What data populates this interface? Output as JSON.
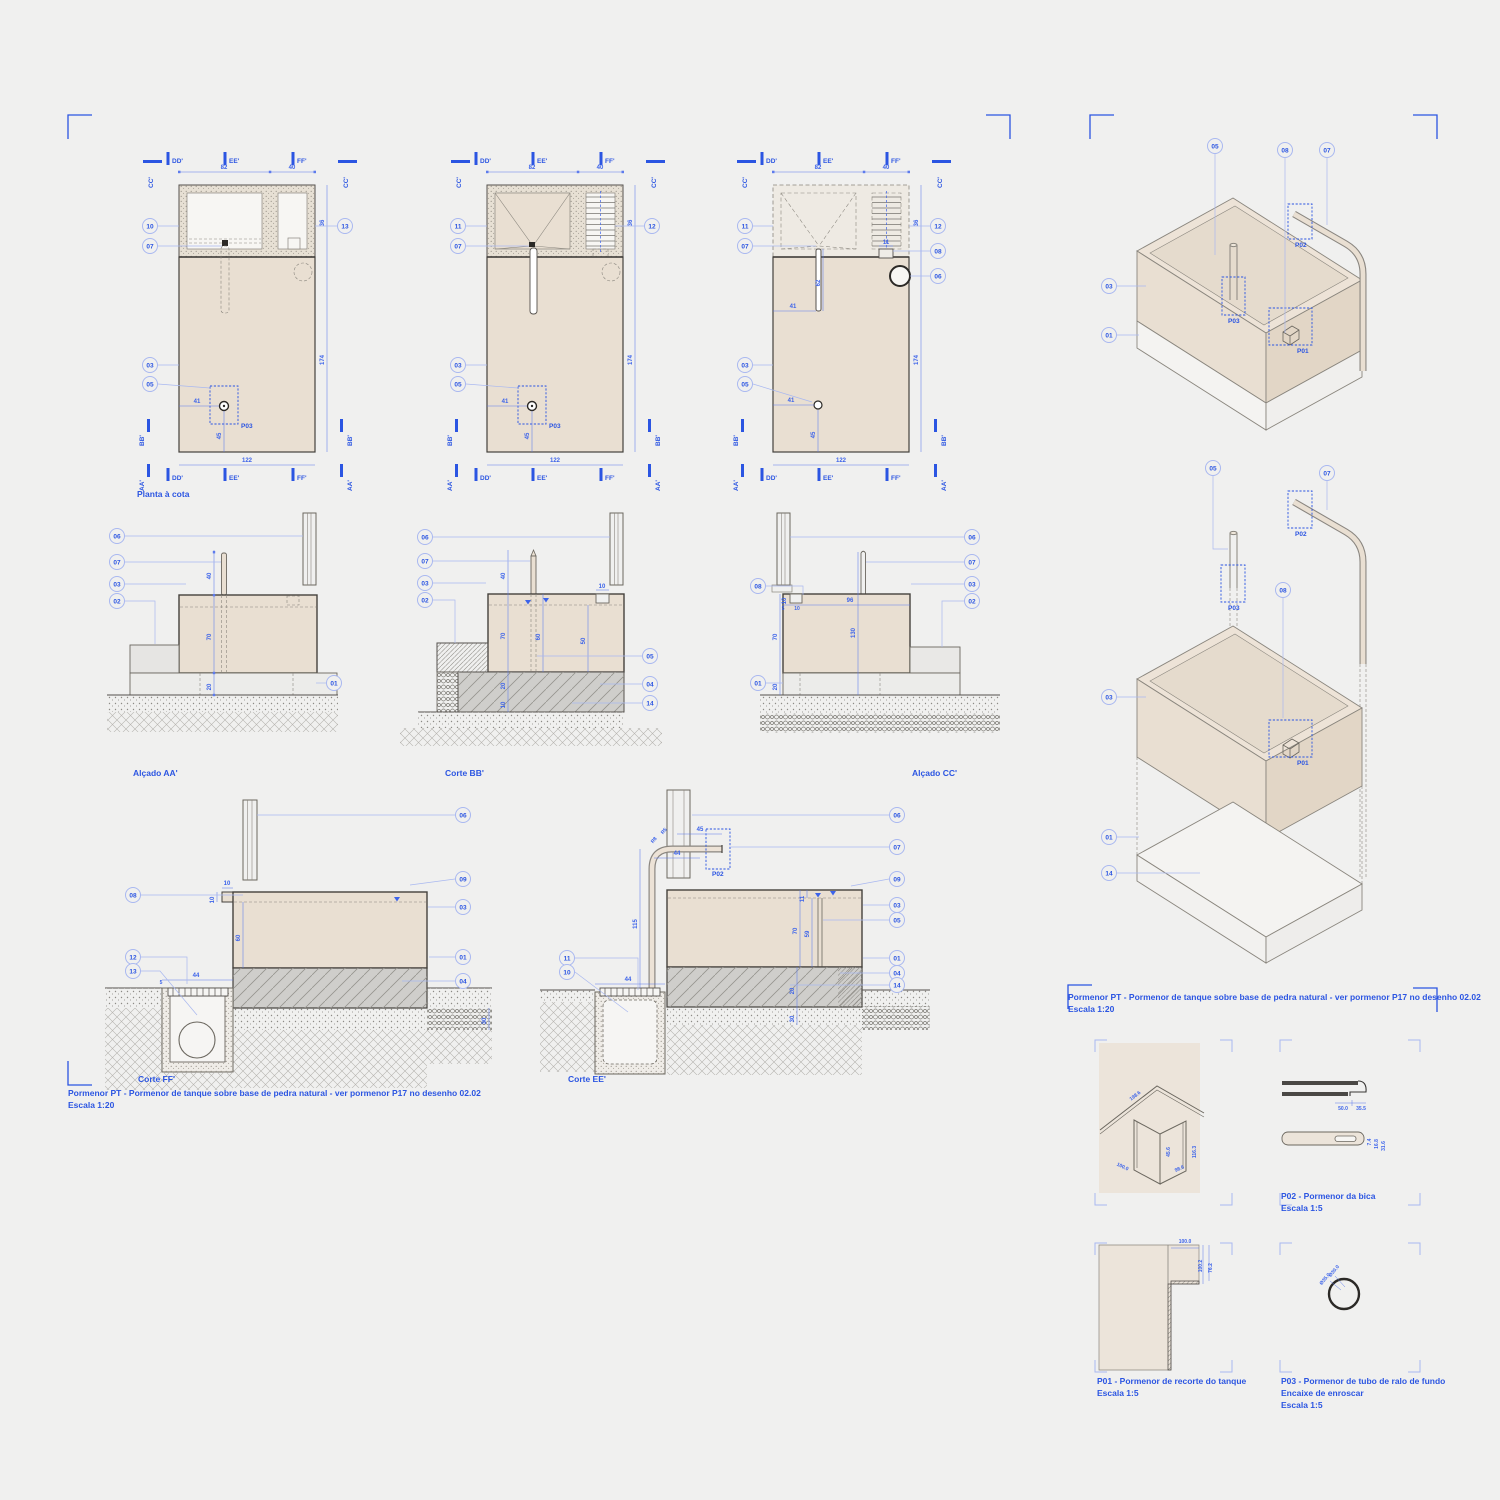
{
  "colors": {
    "background": "#f0f0ef",
    "accent_blue": "#2b55e2",
    "leader_blue": "#a9b8f0",
    "beige": "#e9dfd2",
    "dark_line": "#44413c",
    "concrete": "#cfcecb"
  },
  "labels": {
    "planta": "Planta à cota",
    "alcado_aa": "Alçado AA'",
    "corte_bb": "Corte BB'",
    "alcado_cc": "Alçado CC'",
    "corte_ff": "Corte FF'",
    "corte_ee": "Corte EE'"
  },
  "caption": {
    "line1": "Pormenor PT - Pormenor de tanque sobre base de pedra natural - ver pormenor P17 no desenho 02.02",
    "line2": "Escala 1:20"
  },
  "sections": {
    "dd": "DD'",
    "ee": "EE'",
    "ff": "FF'",
    "aa": "AA'",
    "bb": "BB'",
    "cc": "CC'"
  },
  "plabels": {
    "p01": "P01",
    "p02": "P02",
    "p03": "P03"
  },
  "callouts": {
    "plan1": [
      "10",
      "07",
      "03",
      "05",
      "13"
    ],
    "plan2": [
      "11",
      "07",
      "03",
      "05",
      "12"
    ],
    "plan3": [
      "11",
      "07",
      "03",
      "05",
      "12",
      "08",
      "06"
    ],
    "aa": [
      "06",
      "07",
      "03",
      "02",
      "01"
    ],
    "bb": [
      "06",
      "07",
      "03",
      "02",
      "05",
      "04",
      "14"
    ],
    "cc": [
      "08",
      "01",
      "06",
      "07",
      "03",
      "02"
    ],
    "ff": [
      "08",
      "12",
      "13",
      "06",
      "09",
      "03",
      "01",
      "04"
    ],
    "ee": [
      "11",
      "10",
      "06",
      "07",
      "09",
      "03",
      "05",
      "01",
      "04",
      "14"
    ],
    "axon1": [
      "05",
      "08",
      "07",
      "03",
      "01"
    ],
    "axon2": [
      "05",
      "07",
      "08",
      "03",
      "01",
      "14"
    ]
  },
  "dims": {
    "plan_top": [
      "82",
      "40"
    ],
    "plan_right": [
      "36",
      "174"
    ],
    "plan_bottom": [
      "122"
    ],
    "p03": [
      "41",
      "45"
    ],
    "plan3": [
      "41",
      "62",
      "11"
    ],
    "aa": [
      "40",
      "70",
      "20"
    ],
    "bb": [
      "40",
      "70",
      "20",
      "10",
      "60",
      "50",
      "10"
    ],
    "cc": [
      "10",
      "5",
      "10",
      "96",
      "130",
      "70",
      "20"
    ],
    "ff": [
      "10",
      "10",
      "60",
      "44",
      "5",
      "30"
    ],
    "ee": [
      "45",
      "44",
      "115",
      "11",
      "70",
      "59",
      "20",
      "30",
      "44",
      "R8",
      "R5"
    ],
    "d1": [
      "198.6",
      "45.6",
      "116.3",
      "100.0",
      "98.6"
    ],
    "p02": [
      "50.0",
      "35.5",
      "7.4",
      "16.8",
      "31.6"
    ],
    "p01": [
      "100.0",
      "100.2",
      "76.2"
    ],
    "p03d": [
      "Ø35.0",
      "Ø30.0"
    ]
  },
  "details": {
    "p02c1": "P02 - Pormenor da bica",
    "p02c2": "Escala 1:5",
    "p01c1": "P01 - Pormenor de recorte do tanque",
    "p01c2": "Escala 1:5",
    "p03c1": "P03 - Pormenor de tubo de ralo de fundo",
    "p03c2": "Encaixe de enroscar",
    "p03c3": "Escala 1:5"
  }
}
